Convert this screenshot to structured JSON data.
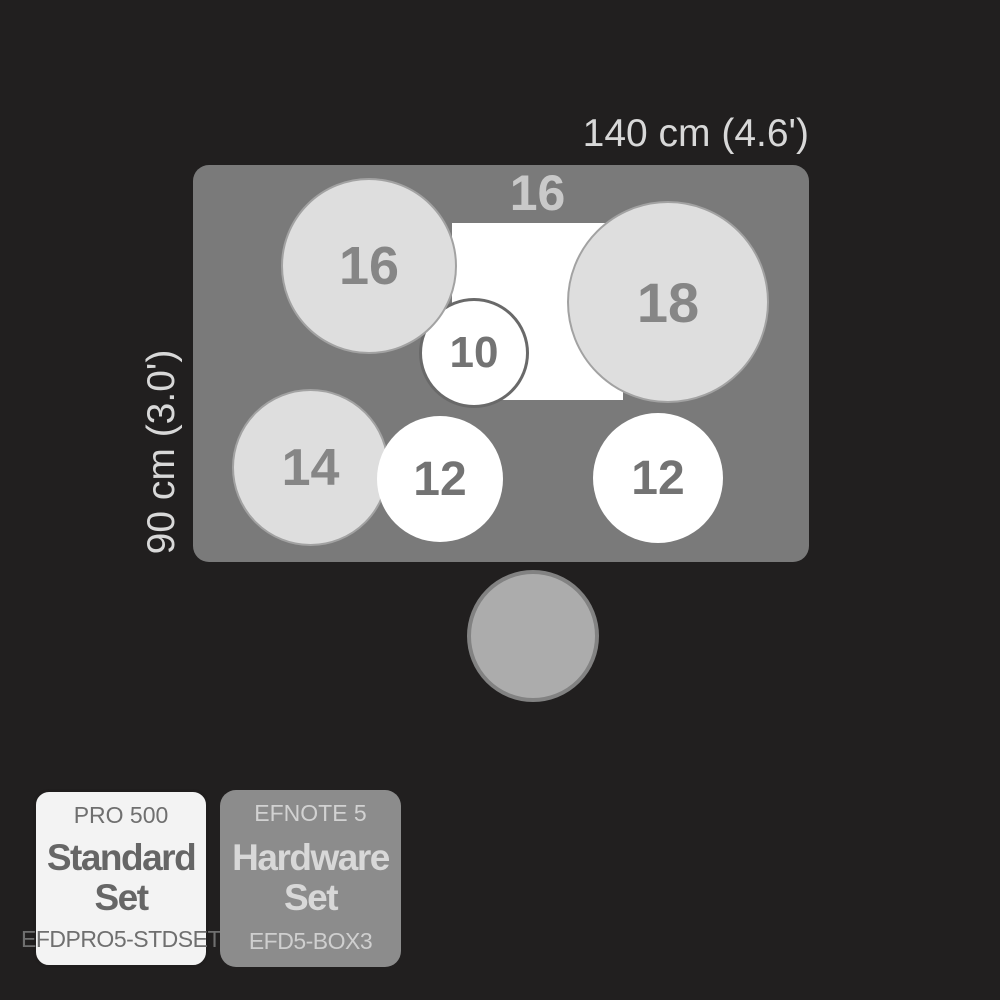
{
  "colors": {
    "background": "#211f1f",
    "floor": "#7a7a7a",
    "pad_gray": "#dedede",
    "pad_white": "#ffffff",
    "throne": "#acacac",
    "dimension_text": "#d8d8d8"
  },
  "diagram": {
    "width_label": "140 cm (4.6')",
    "height_label": "90 cm (3.0')",
    "kick_label": "16",
    "pads": {
      "crash_left": "16",
      "ride_right": "18",
      "tom_small": "10",
      "floor_tom": "14",
      "tom_mid_left": "12",
      "tom_mid_right": "12"
    }
  },
  "badges": {
    "standard_set": {
      "series": "PRO 500",
      "title": "Standard Set",
      "code": "EFDPRO5-STDSET"
    },
    "hardware_set": {
      "series": "EFNOTE 5",
      "title": "Hardware Set",
      "code": "EFD5-BOX3"
    }
  }
}
